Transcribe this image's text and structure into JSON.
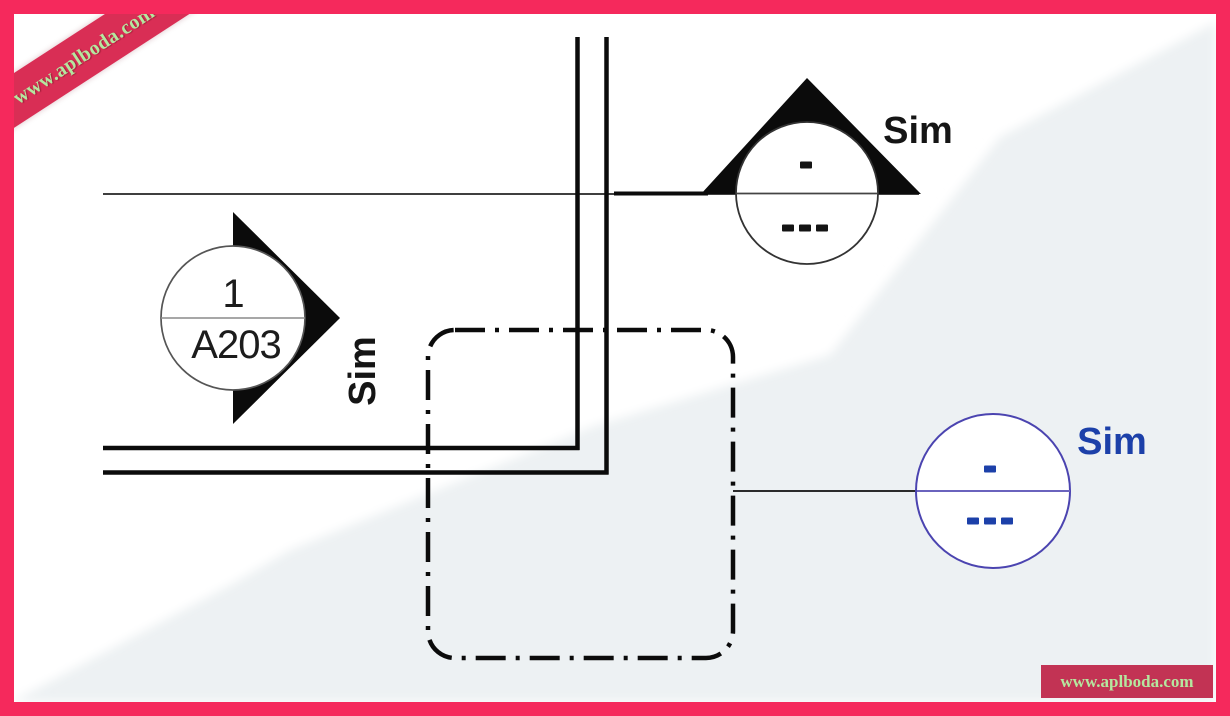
{
  "watermark": {
    "ribbon_text": "www.aplboda.com",
    "badge_text": "www.aplboda.com"
  },
  "section_head_left": {
    "detail_number": "1",
    "sheet_number": "A203",
    "sim_label": "Sim"
  },
  "section_symbol_top": {
    "detail_placeholder": "-",
    "sheet_placeholder": "---",
    "sim_label": "Sim"
  },
  "callout_symbol_blue": {
    "detail_placeholder": "-",
    "sheet_placeholder": "---",
    "sim_label": "Sim"
  },
  "colors": {
    "frame_pink": "#f5295c",
    "ribbon_red": "#d92e55",
    "badge_red": "#c23354",
    "watermark_green": "#b5e79f",
    "shade_gray": "#edf1f3",
    "ink_black": "#141414",
    "blue_text": "#1c40a9",
    "blue_circle": "#4b44b0"
  }
}
